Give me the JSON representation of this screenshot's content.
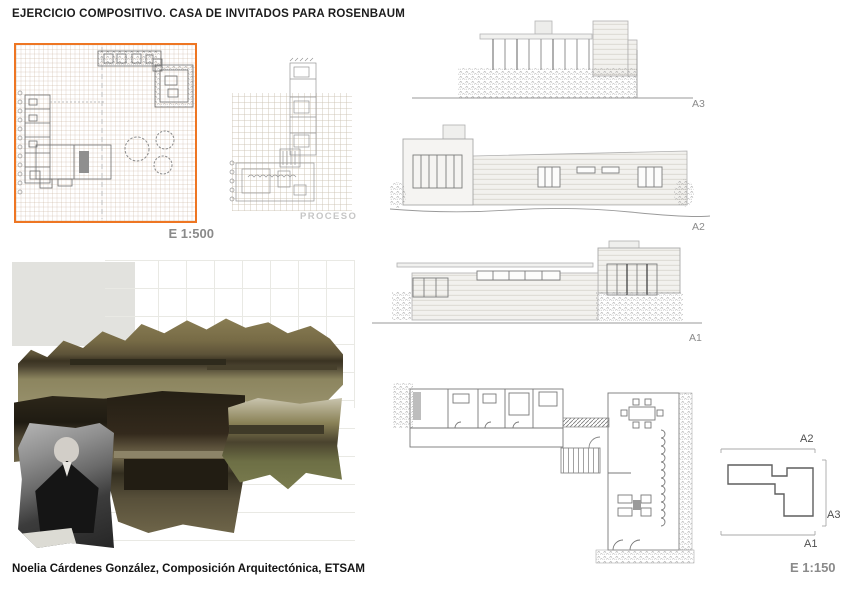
{
  "page": {
    "title": "EJERCICIO COMPOSITIVO. CASA DE INVITADOS PARA ROSENBAUM",
    "credit": "Noelia Cárdenes González, Composición Arquitectónica, ETSAM"
  },
  "site_plan_panel": {
    "scale_label": "E 1:500"
  },
  "process_panel": {
    "watermark": "PROCESO"
  },
  "elevation_panels": [
    {
      "label": "A3"
    },
    {
      "label": "A2"
    },
    {
      "label": "A1"
    }
  ],
  "key_plan": {
    "top_label": "A2",
    "right_label": "A3",
    "bottom_label": "A1",
    "scale_label": "E 1:150"
  },
  "colors": {
    "accent_orange": "#EE7623",
    "label_gray": "#8A8A8A",
    "watermark_gray": "#C6C6C6",
    "text_black": "#1C1C1C",
    "sepia_photo": "#6A6042"
  }
}
